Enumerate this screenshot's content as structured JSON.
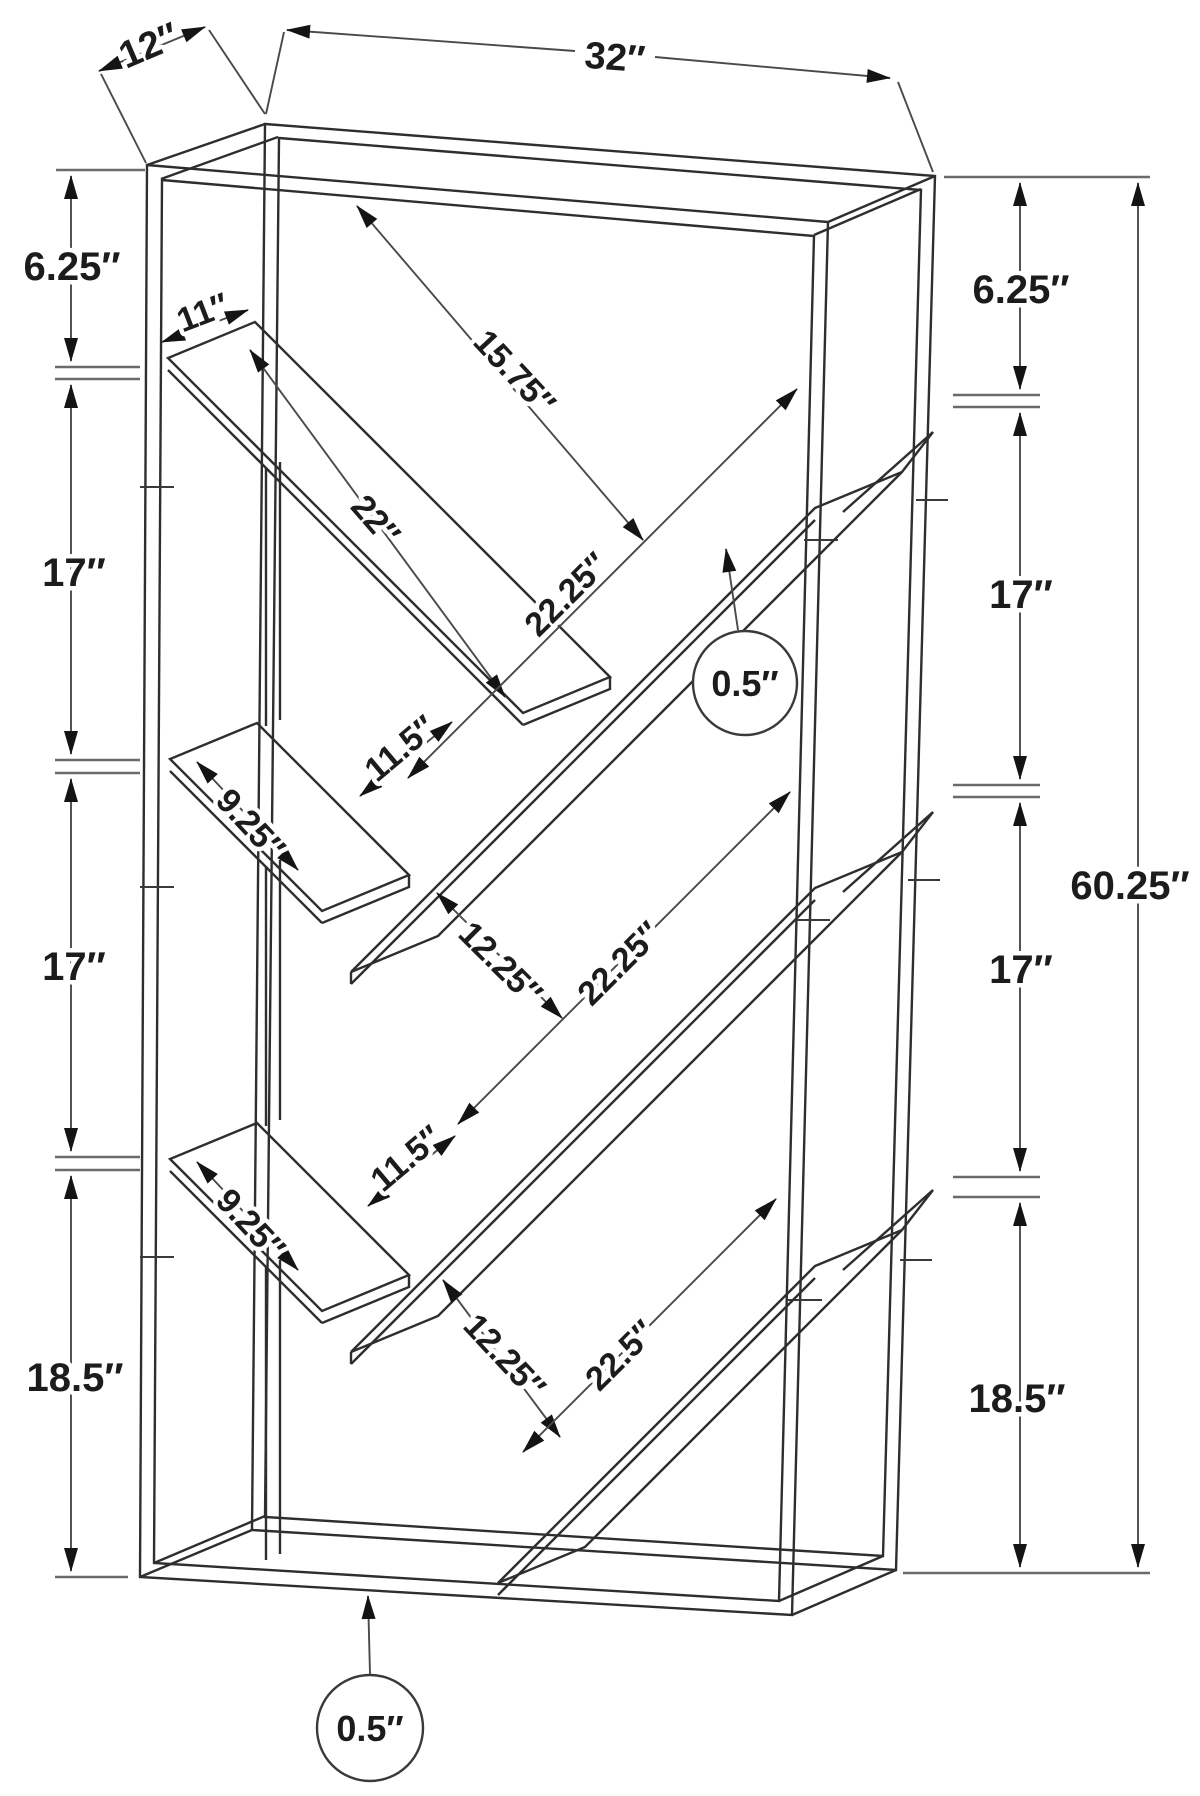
{
  "labels": {
    "depth": "12″",
    "width": "32″",
    "height_total": "60.25″",
    "left_chain": [
      "6.25″",
      "17″",
      "17″",
      "18.5″"
    ],
    "right_chain": [
      "6.25″",
      "17″",
      "17″",
      "18.5″"
    ],
    "top_gap_diag": "15.75″",
    "shelf_depth": "11″",
    "shelf_a_length": "22″",
    "shelf_b_length": "22.25″",
    "v1_gap": "11.5″",
    "shelf_c_length": "9.25″",
    "v2_offset": "12.25″",
    "shelf_d_length": "22.25″",
    "v2_gap": "11.5″",
    "shelf_e_length": "9.25″",
    "v3_offset": "12.25″",
    "shelf_f_length": "22.5″",
    "board_thickness_mid": "0.5″",
    "board_thickness_bottom": "0.5″"
  }
}
